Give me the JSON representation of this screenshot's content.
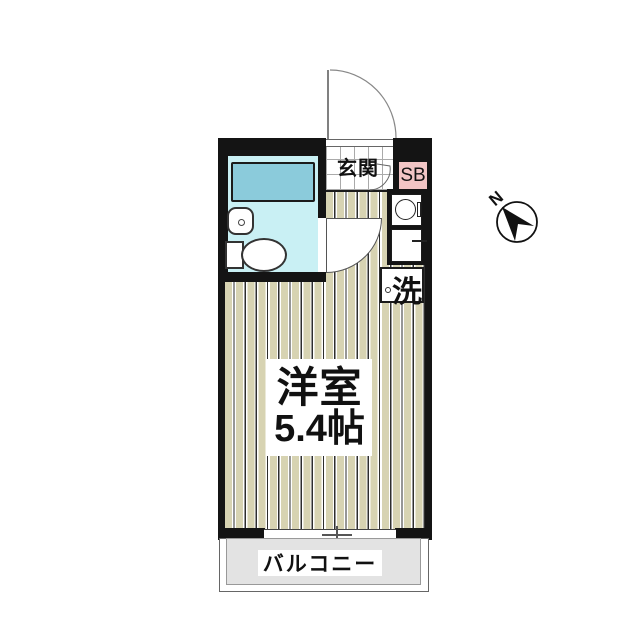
{
  "floorplan": {
    "entrance": {
      "label": "玄関"
    },
    "shoe_box": {
      "label": "SB"
    },
    "laundry": {
      "label": "洗"
    },
    "main_room": {
      "name": "洋室",
      "size": "5.4帖"
    },
    "balcony": {
      "label": "バルコニー"
    },
    "compass": {
      "label": "N",
      "direction": "northwest"
    },
    "icons": [
      "bathtub-icon",
      "toilet-icon",
      "sink-icon",
      "burner-icon",
      "entrance-door-arc-icon",
      "room-door-swing-icon",
      "compass-needle-icon",
      "window-icon",
      "washer-hookup-icon"
    ],
    "colors": {
      "wall": "#141414",
      "flooring": "#d7d3b2",
      "bathroom_floor": "#c9f0f4",
      "bathtub": "#8bcbdb",
      "shoe_box": "#f2c5c5",
      "balcony": "#e3e3e3",
      "background": "#ffffff"
    }
  }
}
